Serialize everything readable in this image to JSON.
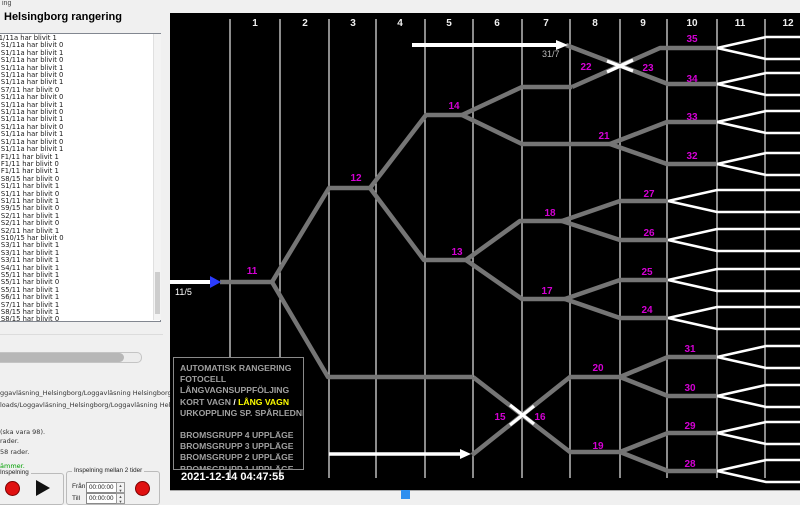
{
  "window": {
    "title": "ing"
  },
  "left_panel": {
    "heading": "Helsingborg rangering",
    "log_lines": [
      "752000: S1/11a har blivit 1",
      "1.752000: S1/11a har blivit 0",
      "1.934000: S1/11a har blivit 1",
      "1.478000: S1/11a har blivit 0",
      "1.488000: S1/11a har blivit 1",
      "1.493000: S1/11a har blivit 0",
      "1.670000: S1/11a har blivit 1",
      "1.622000: S7/11 har blivit 0",
      "1.854000: S1/11a har blivit 0",
      "1.863000: S1/11a har blivit 1",
      "1.873000: S1/11a har blivit 0",
      "1.023000: S1/11a har blivit 1",
      "1.540000: S1/11a har blivit 0",
      "1.550000: S1/11a har blivit 1",
      "1.555000: S1/11a har blivit 0",
      "1.705000: S1/11a har blivit 1",
      "1.655000: F1/11 har blivit 1",
      "1.669000: F1/11 har blivit 0",
      "1.674000: F1/11 har blivit 1",
      "5.263000: S8/15 har blivit 0",
      "7.538000: S1/11 har blivit 1",
      "7.543000: S1/11 har blivit 0",
      "7.548000: S1/11 har blivit 1",
      "4.938000: S9/15 har blivit 0",
      "1.049000: S2/11 har blivit 1",
      "1.054000: S2/11 har blivit 0",
      "1.059000: S2/11 har blivit 1",
      "1.264000: S10/15 har blivit 0",
      "5.241000: S3/11 har blivit 1",
      "1.251000: S3/11 har blivit 1",
      "1.256000: S3/11 har blivit 1",
      "1.821000: S4/11 har blivit 1",
      "1.233000: S5/11 har blivit 1",
      "1.239000: S5/11 har blivit 0",
      "1.243000: S5/11 har blivit 1",
      "1.673000: S6/11 har blivit 1",
      "1.446000: S7/11 har blivit 1",
      "1.076000: S8/15 har blivit 1",
      "1.081000: S8/15 har blivit 0",
      "1.086000: S8/15 har blivit 1",
      "1.561000: S9/15 har blivit 1",
      "4.635000: S10/15 har blivit 1",
      "4.640000: S10/15 har blivit 0",
      "4.646000: S10/15 har blivit 1"
    ],
    "path_line_1": "ggavläsning_Helsingborg/Loggavläsning Helsingborg/loggar/logg.xls",
    "path_line_2": "loads/Loggavläsning_Helsingborg/Loggavläsning Helsingborg/Video",
    "info_line_1": "(ska vara 98).",
    "info_line_2": "rader.",
    "info_line_3": "58 rader.",
    "status_line": "ämmer.",
    "recording_group": {
      "label": "Inspelning"
    },
    "recording_between_group": {
      "label": "Inspelning mellan 2 tider",
      "from_label": "Från",
      "to_label": "Till",
      "from_value": "00:00:00",
      "to_value": "00:00:00"
    }
  },
  "diagram": {
    "timestamp": "2021-12-14 04:47:55",
    "columns": [
      "1",
      "2",
      "3",
      "4",
      "5",
      "6",
      "7",
      "8",
      "9",
      "10",
      "11",
      "12"
    ],
    "column_x": [
      255,
      305,
      353,
      400,
      449,
      497,
      546,
      595,
      643,
      692,
      740,
      788
    ],
    "grid_x": [
      230,
      280,
      329,
      376,
      425,
      473,
      522,
      570,
      620,
      667,
      717,
      765
    ],
    "colors": {
      "grid": "#d8d8d8",
      "track": "#757575",
      "white_track": "#ffffff",
      "label": "#d400d4",
      "column_text": "#f0f0f0",
      "wagon_label": "#b9b9b9",
      "entry_head": "#2b3cff"
    },
    "entry": {
      "label": "11/5",
      "lx": 175,
      "ly": 295,
      "line": [
        [
          170,
          282
        ],
        [
          210,
          282
        ]
      ],
      "head": [
        [
          210,
          276
        ],
        [
          221,
          282
        ],
        [
          210,
          288
        ]
      ]
    },
    "wagon_top": {
      "label": "31/7",
      "lx": 542,
      "ly": 57,
      "line": [
        [
          412,
          45
        ],
        [
          556,
          45
        ]
      ],
      "head": [
        [
          556,
          40
        ],
        [
          568,
          45
        ],
        [
          556,
          50
        ]
      ]
    },
    "wagon_bottom": {
      "line": [
        [
          329,
          454
        ],
        [
          460,
          454
        ]
      ],
      "head": [
        [
          460,
          449
        ],
        [
          471,
          454
        ],
        [
          460,
          459
        ]
      ]
    },
    "gray_tracks": [
      [
        [
          220,
          282
        ],
        [
          272,
          282
        ]
      ],
      [
        [
          272,
          282
        ],
        [
          329,
          188
        ],
        [
          370,
          188
        ]
      ],
      [
        [
          272,
          282
        ],
        [
          328,
          377
        ],
        [
          473,
          377
        ]
      ],
      [
        [
          370,
          188
        ],
        [
          426,
          115
        ],
        [
          462,
          115
        ]
      ],
      [
        [
          370,
          188
        ],
        [
          424,
          260
        ],
        [
          466,
          260
        ]
      ],
      [
        [
          462,
          115
        ],
        [
          522,
          87
        ],
        [
          572,
          87
        ]
      ],
      [
        [
          462,
          115
        ],
        [
          522,
          144
        ],
        [
          610,
          144
        ]
      ],
      [
        [
          572,
          87
        ],
        [
          660,
          48
        ],
        [
          717,
          48
        ]
      ],
      [
        [
          566,
          45
        ],
        [
          668,
          84
        ],
        [
          717,
          84
        ]
      ],
      [
        [
          610,
          144
        ],
        [
          667,
          122
        ],
        [
          717,
          122
        ]
      ],
      [
        [
          610,
          144
        ],
        [
          667,
          164
        ],
        [
          717,
          164
        ]
      ],
      [
        [
          466,
          260
        ],
        [
          520,
          221
        ],
        [
          562,
          221
        ]
      ],
      [
        [
          466,
          260
        ],
        [
          522,
          299
        ],
        [
          565,
          299
        ]
      ],
      [
        [
          562,
          221
        ],
        [
          620,
          201
        ],
        [
          668,
          201
        ]
      ],
      [
        [
          562,
          221
        ],
        [
          620,
          240
        ],
        [
          668,
          240
        ]
      ],
      [
        [
          565,
          299
        ],
        [
          620,
          280
        ],
        [
          668,
          280
        ]
      ],
      [
        [
          565,
          299
        ],
        [
          620,
          318
        ],
        [
          668,
          318
        ]
      ],
      [
        [
          473,
          377
        ],
        [
          570,
          452
        ],
        [
          620,
          452
        ]
      ],
      [
        [
          472,
          455
        ],
        [
          570,
          377
        ],
        [
          620,
          377
        ]
      ],
      [
        [
          620,
          377
        ],
        [
          668,
          357
        ],
        [
          717,
          357
        ]
      ],
      [
        [
          620,
          377
        ],
        [
          668,
          396
        ],
        [
          717,
          396
        ]
      ],
      [
        [
          620,
          452
        ],
        [
          668,
          433
        ],
        [
          717,
          433
        ]
      ],
      [
        [
          620,
          452
        ],
        [
          668,
          471
        ],
        [
          717,
          471
        ]
      ]
    ],
    "fans": [
      {
        "x0": 717,
        "y": 48
      },
      {
        "x0": 717,
        "y": 84
      },
      {
        "x0": 717,
        "y": 122
      },
      {
        "x0": 717,
        "y": 164
      },
      {
        "x0": 668,
        "y": 201
      },
      {
        "x0": 668,
        "y": 240
      },
      {
        "x0": 668,
        "y": 280
      },
      {
        "x0": 668,
        "y": 318
      },
      {
        "x0": 717,
        "y": 357
      },
      {
        "x0": 717,
        "y": 396
      },
      {
        "x0": 717,
        "y": 433
      },
      {
        "x0": 717,
        "y": 471
      }
    ],
    "fan_dx": 49,
    "fan_dy": 11,
    "fan_xend": 800,
    "crossing_marks": [
      [
        [
          607,
          72
        ],
        [
          633,
          60
        ]
      ],
      [
        [
          607,
          61
        ],
        [
          633,
          71
        ]
      ],
      [
        [
          510,
          405
        ],
        [
          534,
          424
        ]
      ],
      [
        [
          510,
          425
        ],
        [
          534,
          406
        ]
      ]
    ],
    "switch_labels": [
      {
        "t": "11",
        "x": 252,
        "y": 274
      },
      {
        "t": "12",
        "x": 356,
        "y": 181
      },
      {
        "t": "13",
        "x": 457,
        "y": 255
      },
      {
        "t": "14",
        "x": 454,
        "y": 109
      },
      {
        "t": "15",
        "x": 500,
        "y": 420
      },
      {
        "t": "16",
        "x": 540,
        "y": 420
      },
      {
        "t": "17",
        "x": 547,
        "y": 294
      },
      {
        "t": "18",
        "x": 550,
        "y": 216
      },
      {
        "t": "19",
        "x": 598,
        "y": 449
      },
      {
        "t": "20",
        "x": 598,
        "y": 371
      },
      {
        "t": "21",
        "x": 604,
        "y": 139
      },
      {
        "t": "22",
        "x": 586,
        "y": 70
      },
      {
        "t": "23",
        "x": 648,
        "y": 71
      },
      {
        "t": "24",
        "x": 647,
        "y": 313
      },
      {
        "t": "25",
        "x": 647,
        "y": 275
      },
      {
        "t": "26",
        "x": 649,
        "y": 236
      },
      {
        "t": "27",
        "x": 649,
        "y": 197
      },
      {
        "t": "28",
        "x": 690,
        "y": 467
      },
      {
        "t": "29",
        "x": 690,
        "y": 429
      },
      {
        "t": "30",
        "x": 690,
        "y": 391
      },
      {
        "t": "31",
        "x": 690,
        "y": 352
      },
      {
        "t": "32",
        "x": 692,
        "y": 159
      },
      {
        "t": "33",
        "x": 692,
        "y": 120
      },
      {
        "t": "34",
        "x": 692,
        "y": 82
      },
      {
        "t": "35",
        "x": 692,
        "y": 42
      }
    ],
    "legend": {
      "lines": [
        "AUTOMATISK RANGERING",
        "FOTOCELL",
        "LÅNGVAGNSUPPFÖLJING"
      ],
      "kort": "KORT VAGN",
      "slash": " / ",
      "lang": "LÅNG VAGN",
      "after": [
        "URKOPPLING SP. SPÅRLEDNING"
      ],
      "broms": [
        "BROMSGRUPP 4 UPPLÄGE",
        "BROMSGRUPP 3 UPPLÄGE",
        "BROMSGRUPP 2 UPPLÄGE",
        "BROMSGRUPP 1 UPPLÄGE"
      ]
    }
  }
}
